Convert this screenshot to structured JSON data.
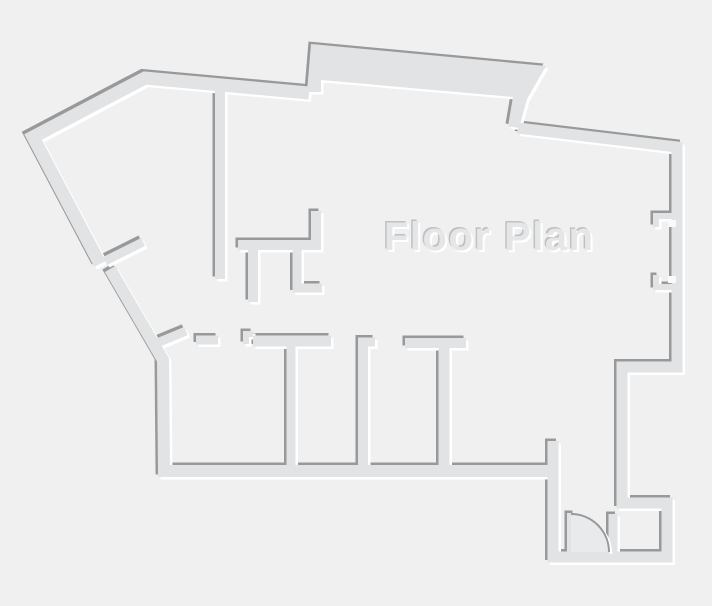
{
  "title": "Floor Plan",
  "colors": {
    "background": "#f0f0f1",
    "wall_fill": "#e1e3e4",
    "edge_dark": "#98999b",
    "edge_light": "#ffffff",
    "door_sector": "#e8eaeb",
    "text_fill": "#e5e6e7",
    "text_dark": "#c0c1c2",
    "text_light": "#ffffff",
    "notch_gap": "#fafafb"
  },
  "canvas": {
    "width": 712,
    "height": 606
  },
  "title_label": {
    "x": 384,
    "y": 250
  },
  "floor_plan": {
    "walls": [
      {
        "name": "outer-wall-top-left",
        "points": [
          [
            100,
            264
          ],
          [
            33,
            137
          ],
          [
            145,
            78
          ],
          [
            309,
            93
          ]
        ],
        "width": 13
      },
      {
        "name": "outer-wall-right",
        "points": [
          [
            518,
            128
          ],
          [
            677,
            147
          ],
          [
            677,
            367
          ],
          [
            622,
            367
          ],
          [
            622,
            503
          ],
          [
            667,
            503
          ],
          [
            667,
            557
          ],
          [
            553,
            557
          ],
          [
            553,
            441
          ]
        ],
        "width": 11
      },
      {
        "name": "outer-wall-bottom-left",
        "points": [
          [
            110,
            269
          ],
          [
            163,
            360
          ],
          [
            164,
            471
          ],
          [
            549,
            471
          ]
        ],
        "width": 12
      },
      {
        "name": "diag-door-jamb-upper",
        "points": [
          [
            105,
            261
          ],
          [
            143,
            242
          ]
        ],
        "width": 9
      },
      {
        "name": "diag-door-jamb-lower",
        "points": [
          [
            157,
            343
          ],
          [
            186,
            331
          ]
        ],
        "width": 9
      },
      {
        "name": "room1-top-stub",
        "points": [
          [
            196,
            340
          ],
          [
            218,
            340
          ]
        ],
        "width": 9
      },
      {
        "name": "room1-step-jamb",
        "points": [
          [
            246,
            344
          ],
          [
            246,
            334
          ],
          [
            253,
            334
          ]
        ],
        "width": 6
      },
      {
        "name": "room2-top-wall",
        "points": [
          [
            253,
            341
          ],
          [
            331,
            341
          ]
        ],
        "width": 11
      },
      {
        "name": "room-separator-1",
        "points": [
          [
            291,
            346
          ],
          [
            291,
            467
          ]
        ],
        "width": 9
      },
      {
        "name": "room-separator-2-flange",
        "points": [
          [
            358,
            342
          ],
          [
            375,
            342
          ]
        ],
        "width": 9
      },
      {
        "name": "room-separator-2",
        "points": [
          [
            363,
            343
          ],
          [
            363,
            467
          ]
        ],
        "width": 10
      },
      {
        "name": "room34-top-bar",
        "points": [
          [
            405,
            343
          ],
          [
            466,
            343
          ]
        ],
        "width": 10
      },
      {
        "name": "room-separator-3",
        "points": [
          [
            444,
            348
          ],
          [
            444,
            467
          ]
        ],
        "width": 11
      },
      {
        "name": "hall-wall-vertical",
        "points": [
          [
            220,
            90
          ],
          [
            220,
            279
          ]
        ],
        "width": 10
      },
      {
        "name": "inner-L-wall",
        "points": [
          [
            238,
            245
          ],
          [
            316,
            245
          ],
          [
            316,
            211
          ]
        ],
        "width": 10
      },
      {
        "name": "hanging-stub-1",
        "points": [
          [
            253,
            250
          ],
          [
            253,
            302
          ]
        ],
        "width": 10
      },
      {
        "name": "hanging-stub-2",
        "points": [
          [
            297,
            250
          ],
          [
            297,
            288
          ],
          [
            322,
            288
          ]
        ],
        "width": 9
      },
      {
        "name": "window-bracket-1",
        "points": [
          [
            674,
            216
          ],
          [
            656,
            216
          ],
          [
            656,
            227
          ]
        ],
        "width": 6
      },
      {
        "name": "window-bracket-2",
        "points": [
          [
            656,
            275
          ],
          [
            656,
            287
          ],
          [
            674,
            287
          ]
        ],
        "width": 6
      },
      {
        "name": "door-leaf",
        "points": [
          [
            571,
            513
          ],
          [
            571,
            552
          ]
        ],
        "width": 8
      },
      {
        "name": "door-jamb-right",
        "points": [
          [
            613,
            514
          ],
          [
            613,
            556
          ]
        ],
        "width": 9
      }
    ],
    "bump_polygon": [
      [
        307,
        92
      ],
      [
        311,
        44
      ],
      [
        546,
        66
      ],
      [
        527,
        99
      ],
      [
        519,
        128
      ],
      [
        508,
        126
      ],
      [
        513,
        97
      ],
      [
        321,
        80
      ],
      [
        321,
        92
      ]
    ],
    "door": {
      "sector_path": "M 571 552 L 571 514 A 38 38 0 0 1 609 552 Z",
      "arc_path": "M 571 514 A 38 38 0 0 1 609 552"
    },
    "window_gap_rects": [
      [
        668,
        220,
        8,
        7
      ],
      [
        668,
        276,
        8,
        7
      ]
    ],
    "emboss": {
      "dark_offset": [
        -2.5,
        -2.5
      ],
      "light_offset": [
        2.5,
        2.5
      ],
      "text_dark_offset": [
        -1.5,
        -1.5
      ],
      "text_light_offset": [
        2,
        2
      ]
    }
  }
}
